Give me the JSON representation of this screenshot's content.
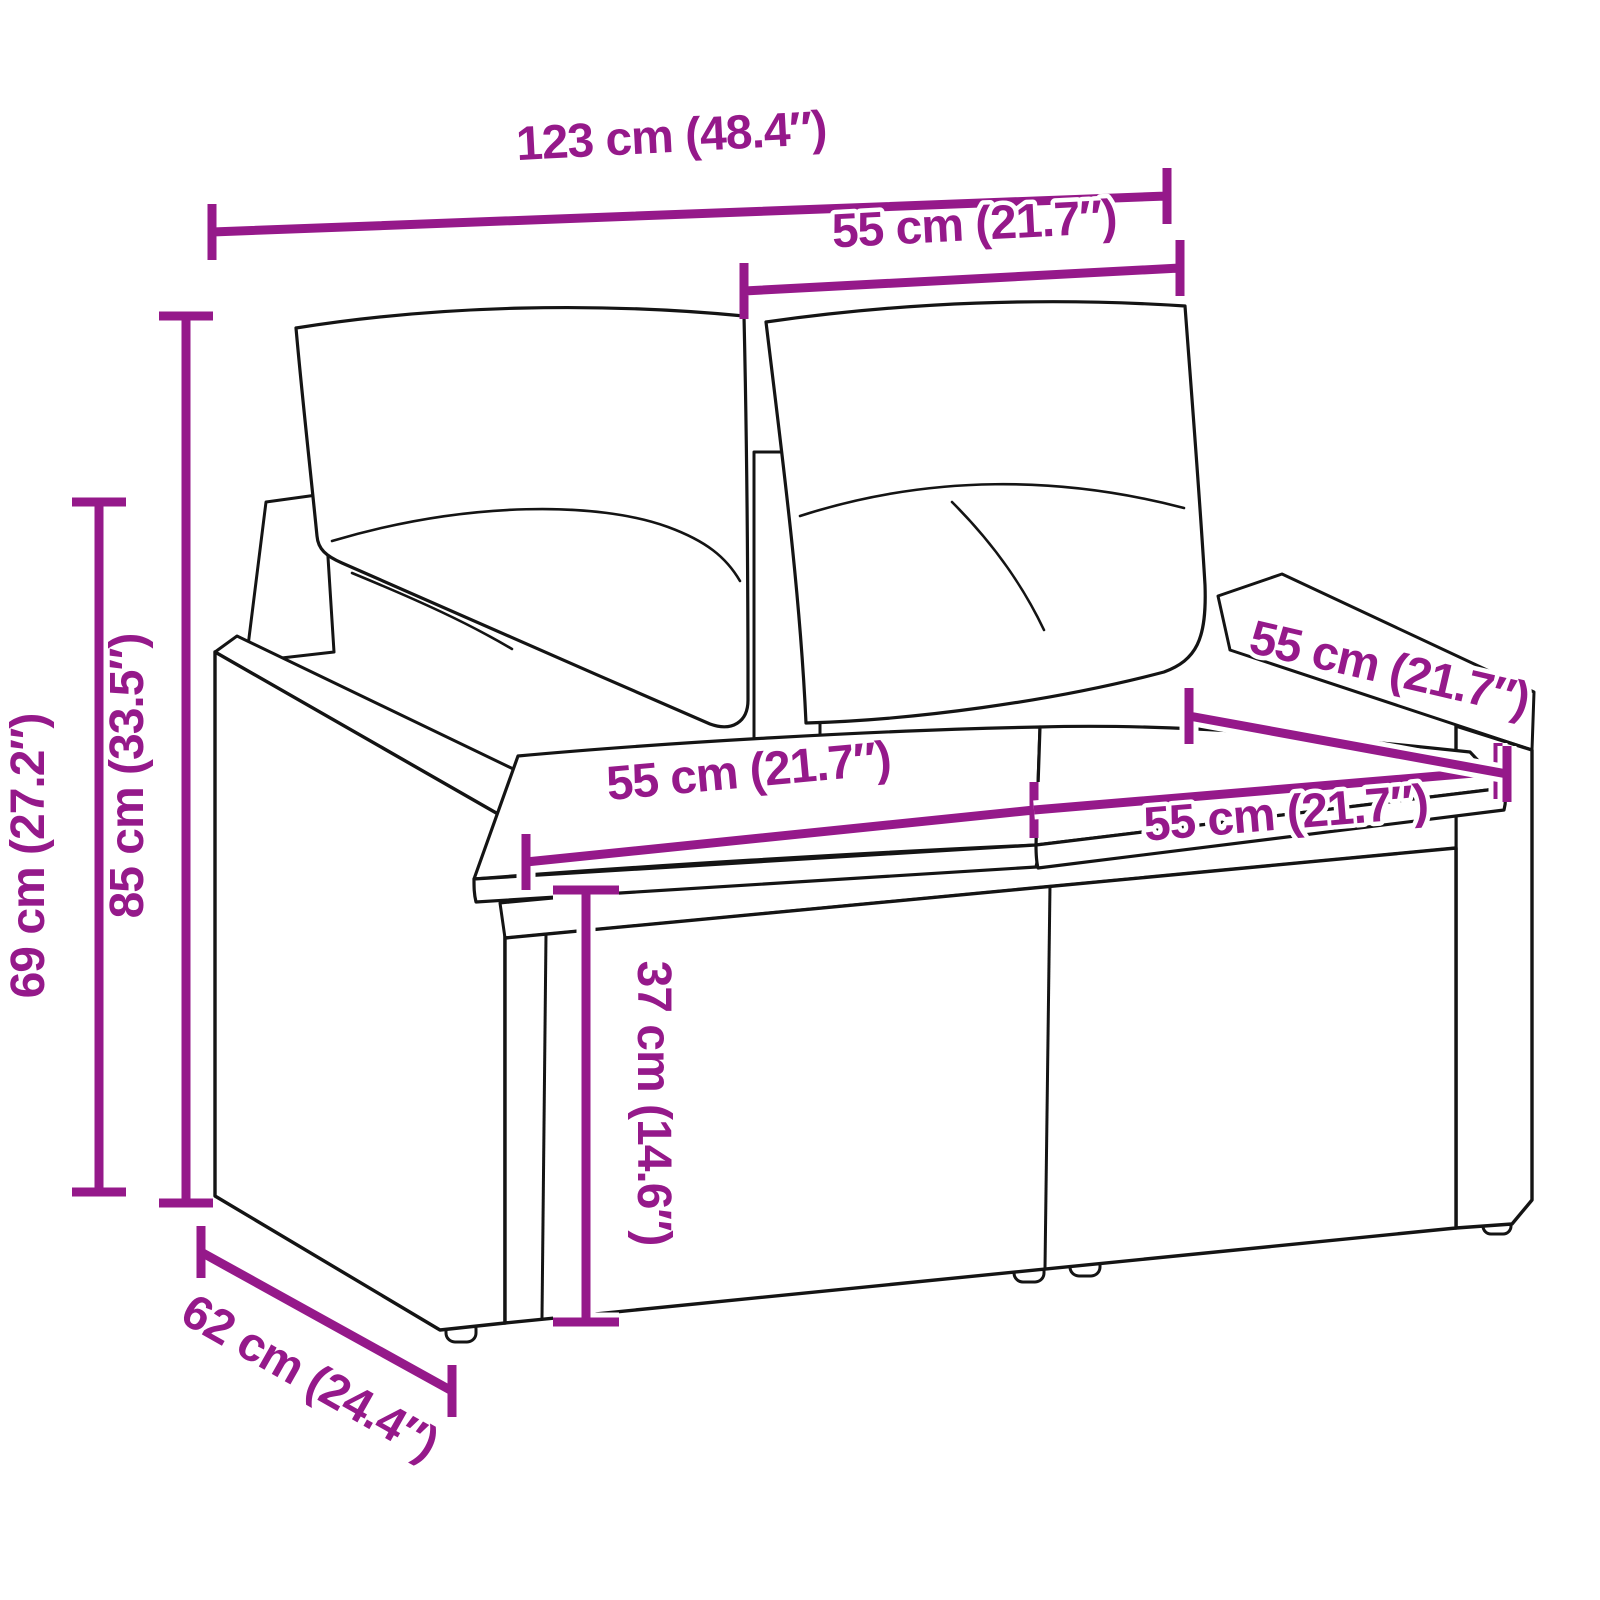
{
  "style": {
    "dimension_color": "#95198A",
    "art_color": "#141414",
    "background": "#FFFFFF"
  },
  "product": {
    "name": "rattan-two-seater-garden-sofa-with-cushions",
    "view": "three-quarter perspective line drawing with woven rattan texture, two back cushions and two seat cushions"
  },
  "dimensions": [
    {
      "id": "overall-width",
      "label": "123 cm (48.4″)"
    },
    {
      "id": "back-section-width",
      "label": "55 cm (21.7″)"
    },
    {
      "id": "overall-height",
      "label": "85 cm (33.5″)"
    },
    {
      "id": "back-frame-height",
      "label": "69 cm (27.2″)"
    },
    {
      "id": "seat-width-left",
      "label": "55 cm (21.7″)"
    },
    {
      "id": "seat-width-right",
      "label": "55 cm (21.7″)"
    },
    {
      "id": "seat-depth",
      "label": "55 cm (21.7″)"
    },
    {
      "id": "seat-height",
      "label": "37 cm (14.6″)"
    },
    {
      "id": "overall-depth",
      "label": "62 cm (24.4″)"
    }
  ]
}
